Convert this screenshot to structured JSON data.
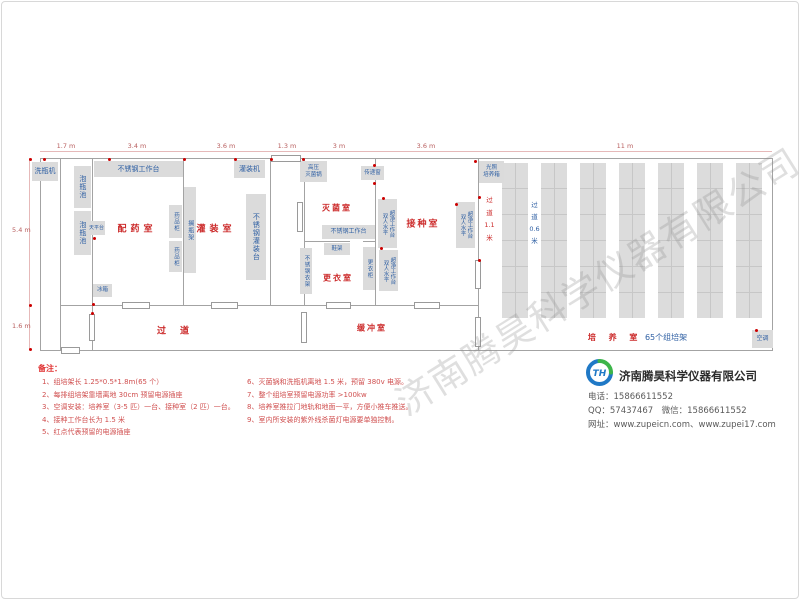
{
  "page": {
    "watermark": "济南腾昊科学仪器有限公司"
  },
  "colors": {
    "room_label": "#cc2b2b",
    "equipment_text": "#2e5fa3",
    "equipment_fill": "#dbdbdb",
    "wall": "#a3a3a3",
    "dimension": "#b85e5e",
    "note_title": "#e03030",
    "note_text": "#d05050",
    "outlet": "#cc0000",
    "rack_fill": "#dcdcdc",
    "rack_line": "#c7c7c7"
  },
  "dimensions": {
    "top": [
      {
        "label": "1.7 m",
        "cx": 66
      },
      {
        "label": "3.4 m",
        "cx": 137
      },
      {
        "label": "3.6 m",
        "cx": 226
      },
      {
        "label": "1.3 m",
        "cx": 287
      },
      {
        "label": "3 m",
        "cx": 339
      },
      {
        "label": "3.6 m",
        "cx": 426
      },
      {
        "label": "11 m",
        "cx": 625
      }
    ],
    "left": [
      {
        "label": "5.4 m",
        "cy": 230
      },
      {
        "label": "1.6 m",
        "cy": 326
      }
    ]
  },
  "plan": {
    "walls": [
      {
        "x": 40,
        "y": 158,
        "w": 732,
        "h": 1
      },
      {
        "x": 40,
        "y": 350,
        "w": 732,
        "h": 1
      },
      {
        "x": 60,
        "y": 305,
        "w": 418,
        "h": 1
      },
      {
        "x": 304,
        "y": 241,
        "w": 46,
        "h": 1
      },
      {
        "x": 363,
        "y": 241,
        "w": 12,
        "h": 1
      },
      {
        "x": 40,
        "y": 158,
        "w": 1,
        "h": 193
      },
      {
        "x": 60,
        "y": 158,
        "w": 1,
        "h": 193
      },
      {
        "x": 92,
        "y": 158,
        "w": 1,
        "h": 193
      },
      {
        "x": 183,
        "y": 158,
        "w": 1,
        "h": 147
      },
      {
        "x": 270,
        "y": 158,
        "w": 1,
        "h": 147
      },
      {
        "x": 304,
        "y": 158,
        "w": 1,
        "h": 147
      },
      {
        "x": 375,
        "y": 158,
        "w": 1,
        "h": 147
      },
      {
        "x": 478,
        "y": 158,
        "w": 1,
        "h": 193
      },
      {
        "x": 772,
        "y": 158,
        "w": 1,
        "h": 193
      }
    ],
    "doors": [
      {
        "x": 271,
        "y": 155,
        "w": 30,
        "h": 7
      },
      {
        "x": 122,
        "y": 302,
        "w": 28,
        "h": 7
      },
      {
        "x": 211,
        "y": 302,
        "w": 27,
        "h": 7
      },
      {
        "x": 326,
        "y": 302,
        "w": 25,
        "h": 7
      },
      {
        "x": 414,
        "y": 302,
        "w": 26,
        "h": 7
      },
      {
        "x": 61,
        "y": 347,
        "w": 19,
        "h": 7
      },
      {
        "x": 89,
        "y": 314,
        "w": 6,
        "h": 27
      },
      {
        "x": 301,
        "y": 312,
        "w": 6,
        "h": 31
      },
      {
        "x": 297,
        "y": 202,
        "w": 6,
        "h": 30
      },
      {
        "x": 475,
        "y": 260,
        "w": 6,
        "h": 29
      },
      {
        "x": 475,
        "y": 317,
        "w": 6,
        "h": 30
      }
    ],
    "outlets": [
      [
        43,
        158
      ],
      [
        108,
        158
      ],
      [
        183,
        158
      ],
      [
        234,
        158
      ],
      [
        270,
        158
      ],
      [
        302,
        158
      ],
      [
        373,
        164
      ],
      [
        373,
        182
      ],
      [
        382,
        197
      ],
      [
        380,
        247
      ],
      [
        455,
        203
      ],
      [
        474,
        160
      ],
      [
        478,
        196
      ],
      [
        478,
        259
      ],
      [
        92,
        303
      ],
      [
        93,
        237
      ],
      [
        29,
        158
      ],
      [
        29,
        304
      ],
      [
        29,
        348
      ],
      [
        755,
        329
      ],
      [
        91,
        312
      ]
    ],
    "equipment": [
      {
        "name": "bottle-washing-machine",
        "label": "洗瓶机",
        "x": 32,
        "y": 162,
        "w": 26,
        "h": 19,
        "o": "h",
        "fs": 7
      },
      {
        "name": "soak-pool-1",
        "label": "泡瓶池",
        "x": 74,
        "y": 166,
        "w": 17,
        "h": 42,
        "o": "v",
        "fs": 7
      },
      {
        "name": "soak-pool-2",
        "label": "泡瓶池",
        "x": 74,
        "y": 211,
        "w": 17,
        "h": 44,
        "o": "v",
        "fs": 7
      },
      {
        "name": "ss-workbench-top",
        "label": "不锈钢工作台",
        "x": 94,
        "y": 161,
        "w": 89,
        "h": 16,
        "o": "h",
        "fs": 7
      },
      {
        "name": "balance-table",
        "label": "天平台",
        "x": 88,
        "y": 221,
        "w": 17,
        "h": 14,
        "o": "h",
        "fs": 5
      },
      {
        "name": "fridge",
        "label": "冰箱",
        "x": 93,
        "y": 284,
        "w": 19,
        "h": 13,
        "o": "h",
        "fs": 5.5
      },
      {
        "name": "medicine-cabinet-1",
        "label": "药品柜",
        "x": 169,
        "y": 205,
        "w": 13,
        "h": 33,
        "o": "v",
        "fs": 5.5
      },
      {
        "name": "medicine-cabinet-2",
        "label": "药品柜",
        "x": 169,
        "y": 241,
        "w": 13,
        "h": 31,
        "o": "v",
        "fs": 5.5
      },
      {
        "name": "bottle-shelf-rack",
        "label": "搁瓶架",
        "x": 184,
        "y": 187,
        "w": 12,
        "h": 86,
        "o": "v",
        "fs": 6
      },
      {
        "name": "filling-machine",
        "label": "灌装机",
        "x": 234,
        "y": 160,
        "w": 31,
        "h": 18,
        "o": "h",
        "fs": 7
      },
      {
        "name": "ss-filling-table",
        "label": "不锈钢灌装台",
        "x": 246,
        "y": 194,
        "w": 20,
        "h": 86,
        "o": "v",
        "fs": 7
      },
      {
        "name": "autoclave",
        "label": "高压\n灭菌锅",
        "x": 300,
        "y": 161,
        "w": 27,
        "h": 21,
        "o": "h2",
        "fs": 5.5
      },
      {
        "name": "pass-through-window",
        "label": "传递窗",
        "x": 361,
        "y": 166,
        "w": 23,
        "h": 14,
        "o": "h",
        "fs": 5.5
      },
      {
        "name": "clean-bench-1",
        "label": "双人水平\n超净工作台",
        "x": 378,
        "y": 199,
        "w": 19,
        "h": 49,
        "o": "v2",
        "fs": 5.5
      },
      {
        "name": "ss-workbench-mid",
        "label": "不锈钢工作台",
        "x": 322,
        "y": 225,
        "w": 53,
        "h": 14,
        "o": "h",
        "fs": 6
      },
      {
        "name": "shoe-rack",
        "label": "鞋架",
        "x": 324,
        "y": 243,
        "w": 26,
        "h": 12,
        "o": "h",
        "fs": 5.5
      },
      {
        "name": "ss-clothes-rack",
        "label": "不锈钢衣架",
        "x": 300,
        "y": 248,
        "w": 12,
        "h": 46,
        "o": "v",
        "fs": 5.5
      },
      {
        "name": "locker",
        "label": "更衣柜",
        "x": 363,
        "y": 247,
        "w": 12,
        "h": 43,
        "o": "v",
        "fs": 5.5
      },
      {
        "name": "clean-bench-2",
        "label": "双人水平\n超净工作台",
        "x": 379,
        "y": 250,
        "w": 19,
        "h": 41,
        "o": "v2",
        "fs": 5.5
      },
      {
        "name": "clean-bench-3",
        "label": "双人水平\n超净工作台",
        "x": 456,
        "y": 202,
        "w": 19,
        "h": 46,
        "o": "v2",
        "fs": 5.5
      },
      {
        "name": "light-incubator",
        "label": "光照\n培养箱",
        "x": 479,
        "y": 161,
        "w": 25,
        "h": 22,
        "o": "h2",
        "fs": 5.5
      },
      {
        "name": "air-conditioner",
        "label": "空调",
        "x": 752,
        "y": 330,
        "w": 21,
        "h": 18,
        "o": "h",
        "fs": 6
      }
    ],
    "rooms": [
      {
        "name": "medicine-prep-room",
        "label": "配药室",
        "cx": 137,
        "cy": 228,
        "fs": 9,
        "ls": 4
      },
      {
        "name": "filling-room",
        "label": "灌装室",
        "cx": 216,
        "cy": 228,
        "fs": 9,
        "ls": 4
      },
      {
        "name": "sterilization-room",
        "label": "灭菌室",
        "cx": 337,
        "cy": 208,
        "fs": 8,
        "ls": 2
      },
      {
        "name": "inoculation-room",
        "label": "接种室",
        "cx": 423,
        "cy": 223,
        "fs": 9,
        "ls": 2
      },
      {
        "name": "changing-room",
        "label": "更衣室",
        "cx": 338,
        "cy": 278,
        "fs": 8,
        "ls": 2
      },
      {
        "name": "corridor",
        "label": "过道",
        "cx": 180,
        "cy": 330,
        "fs": 9,
        "ls": 14
      },
      {
        "name": "buffer-room",
        "label": "缓冲室",
        "cx": 372,
        "cy": 328,
        "fs": 8,
        "ls": 2
      }
    ],
    "aisles": [
      {
        "name": "aisle-1-1m",
        "label": "过\n道\n1.1\n米",
        "x": 481,
        "y": 194,
        "w": 17,
        "color": "room_label",
        "fs": 6.5,
        "lh": 12.5
      },
      {
        "name": "aisle-0-6m",
        "label": "过\n道\n0.6\n米",
        "x": 526,
        "y": 199,
        "w": 17,
        "color": "equipment_text",
        "fs": 6.5,
        "lh": 12
      }
    ],
    "culture": {
      "label_red": "培 养 室",
      "label_blue": "65个组培架"
    },
    "racks": {
      "count": 7,
      "x0": 502,
      "period": 39,
      "width": 26,
      "y": 163,
      "height": 155,
      "cell": 26
    }
  },
  "notes": {
    "title": "备注：",
    "col1": [
      "1、组培架长 1.25*0.5*1.8m(65 个）",
      "2、每排组培架靠墙离地 30cm 预留电源插座",
      "3、空调安装：培养室（3-5 匹）一台、接种室（2 匹）一台。",
      "4、接种工作台长为 1.5 米",
      "5、红点代表预留的电源插座"
    ],
    "col2": [
      "6、灭菌锅和洗瓶机离地 1.5 米，预留 380v 电源。",
      "7、整个组培室预留电源功率 >100kw",
      "8、培养室推拉门地轨和地面一平，方便小推车推送。",
      "9、室内所安装的紫外线杀菌灯电源要单独控制。"
    ]
  },
  "company": {
    "logo_text": "TH",
    "name": "济南腾昊科学仪器有限公司",
    "phone": "电话：15866611552",
    "qq_wechat": "QQ：57437467　微信：15866611552",
    "web": "网址：www.zupeicn.com、www.zupei17.com"
  }
}
